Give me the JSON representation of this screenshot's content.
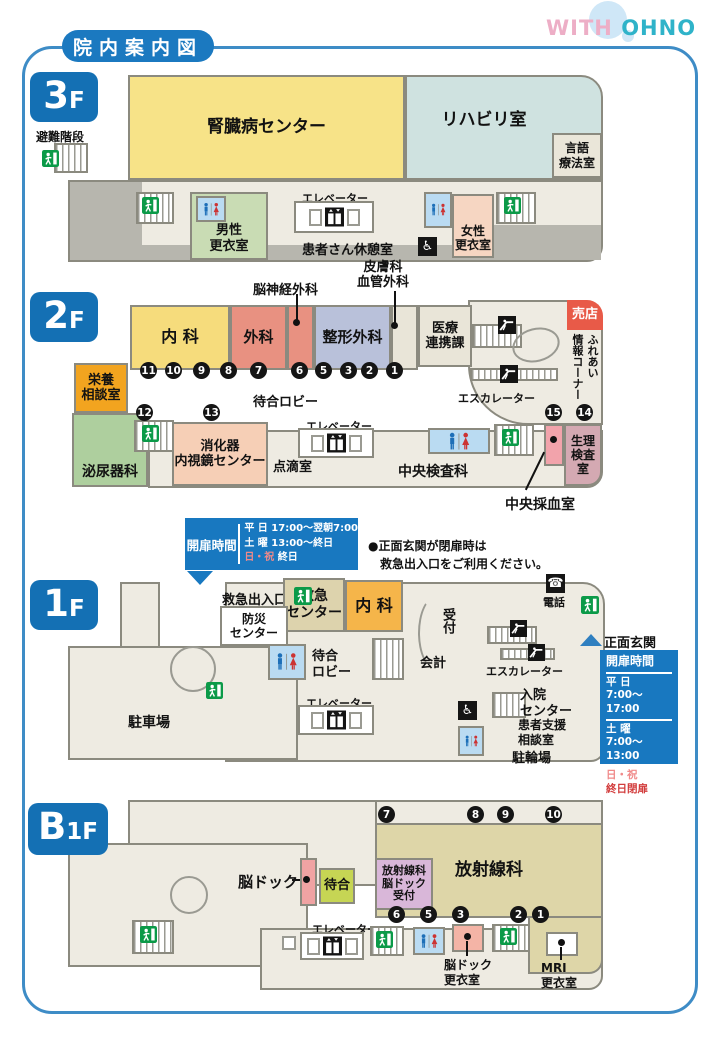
{
  "title": "院内案内図",
  "logo": {
    "with": "WITH",
    "ohno": "OHNO"
  },
  "icons": {
    "wheelchair": "♿",
    "phone": "☎"
  },
  "colors": {
    "frame_blue": "#3e8cc6",
    "floor_tag_blue": "#1470b4",
    "sign_blue": "#1878c0",
    "shop_red": "#e85a48",
    "holiday_pink": "#f08a8a",
    "closed_red": "#d23c3c",
    "exit_green": "#0b9a48"
  },
  "f3": {
    "floor_big": "3",
    "floor_small": "F",
    "evac_stairs": "避難階段",
    "kidney_center": "腎臓病センター",
    "rehab_room": "リハビリ室",
    "speech_room": [
      "言語",
      "療法室"
    ],
    "mens_locker": [
      "男性",
      "更衣室"
    ],
    "elevator": "エレベーター",
    "patients_lounge": "患者さん休憩室",
    "womens_locker": [
      "女性",
      "更衣室"
    ]
  },
  "f2": {
    "floor_big": "2",
    "floor_small": "F",
    "neurosurgery": "脳神経外科",
    "dermatology": [
      "皮膚科",
      "血管外科"
    ],
    "internal_medicine": "内 科",
    "surgery": "外科",
    "orthopedics": "整形外科",
    "medical_cooperation": [
      "医療",
      "連携課"
    ],
    "shop": "売店",
    "info_corner": [
      "ふれあい",
      "情報コーナー"
    ],
    "escalator": "エスカレーター",
    "waiting_lobby": "待合ロビー",
    "nutrition_room": [
      "栄養",
      "相談室"
    ],
    "urology": "泌尿器科",
    "endoscopy_center": [
      "消化器",
      "内視鏡センター"
    ],
    "iv_room": "点滴室",
    "elevator": "エレベーター",
    "central_lab": "中央検査科",
    "blood_collection": "中央採血室",
    "physiology_lab": [
      "生理",
      "検査室"
    ],
    "numbers_row": [
      "11",
      "10",
      "9",
      "8",
      "7",
      "6",
      "5",
      "3",
      "2",
      "1"
    ],
    "numbers_mid": [
      "12",
      "13"
    ],
    "numbers_right": [
      "15",
      "14"
    ]
  },
  "f1": {
    "floor_big": "1",
    "floor_small": "F",
    "hours_top": {
      "title": "開扉時間",
      "weekday_label": "平 日",
      "weekday_time": "17:00〜翌朝7:00",
      "saturday_label": "土 曜",
      "saturday_time": "13:00〜終日",
      "holiday_label": "日・祝",
      "holiday_time": "終日"
    },
    "notice": [
      "●正面玄関が閉扉時は",
      "救急出入口をご利用ください。"
    ],
    "emergency_entrance": "救急出入口",
    "emergency_center": [
      "救急",
      "センター"
    ],
    "internal_medicine": "内 科",
    "disaster_center": [
      "防災",
      "センター"
    ],
    "waiting_lobby": [
      "待合",
      "ロビー"
    ],
    "reception": "受付",
    "cashier": "会計",
    "escalator": "エスカレーター",
    "phone": "電話",
    "main_entrance": "正面玄関",
    "hours_right": {
      "title": "開扉時間",
      "weekday_label": "平 日",
      "weekday_time": "7:00〜17:00",
      "saturday_label": "土 曜",
      "saturday_time": "7:00〜13:00",
      "holiday_label": "日・祝",
      "holiday_time": "終日閉扉"
    },
    "parking": "駐車場",
    "elevator": "エレベーター",
    "admission_center": [
      "入院",
      "センター"
    ],
    "patient_support": [
      "患者支援",
      "相談室"
    ],
    "bicycle_parking": "駐輪場"
  },
  "b1f": {
    "floor_big": "B",
    "floor_small": "1F",
    "brain_dock": "脳ドック",
    "waiting": "待合",
    "radiology": "放射線科",
    "radiology_reception": [
      "放射線科",
      "脳ドック",
      "受付"
    ],
    "elevator": "エレベーター",
    "brain_dock_locker": [
      "脳ドック",
      "更衣室"
    ],
    "mri_locker": [
      "MRI",
      "更衣室"
    ],
    "numbers_top": [
      "7",
      "8",
      "9",
      "10"
    ],
    "numbers_bottom": [
      "6",
      "5",
      "3",
      "2",
      "1"
    ]
  }
}
